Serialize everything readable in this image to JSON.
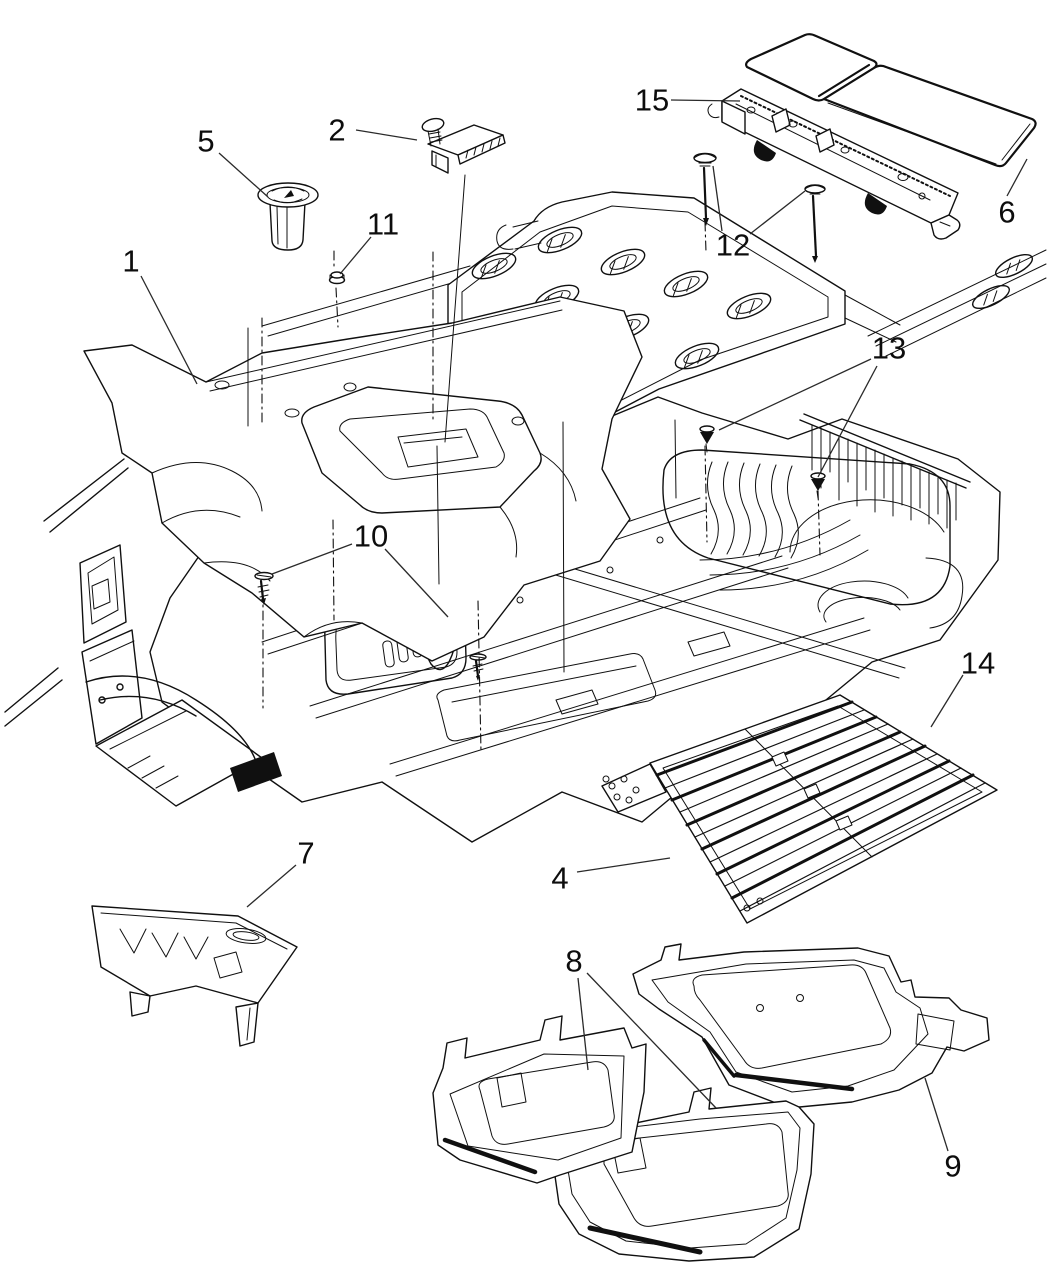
{
  "diagram": {
    "description": "Black-and-white exploded parts line diagram of vehicle floor carpet, mats, bins and fasteners with numbered callouts",
    "background_color": "#ffffff",
    "ink_color": "#101010",
    "label_color": "#0d0d0d",
    "label_font_size": 31,
    "callout_numbers": [
      "1",
      "2",
      "4",
      "5",
      "6",
      "7",
      "8",
      "9",
      "10",
      "11",
      "12",
      "13",
      "14",
      "15"
    ]
  },
  "callouts": [
    {
      "number": "1",
      "x": 131,
      "y": 261,
      "leaders": [
        [
          141,
          276,
          197,
          384
        ]
      ]
    },
    {
      "number": "2",
      "x": 337,
      "y": 130,
      "leaders": [
        [
          356,
          130,
          417,
          140
        ]
      ]
    },
    {
      "number": "4",
      "x": 560,
      "y": 878,
      "leaders": [
        [
          577,
          872,
          670,
          858
        ]
      ]
    },
    {
      "number": "5",
      "x": 206,
      "y": 141,
      "leaders": [
        [
          219,
          153,
          268,
          197
        ]
      ]
    },
    {
      "number": "6",
      "x": 1007,
      "y": 212,
      "leaders": [
        [
          1007,
          196,
          1027,
          159
        ]
      ]
    },
    {
      "number": "7",
      "x": 306,
      "y": 853,
      "leaders": [
        [
          296,
          865,
          247,
          907
        ]
      ]
    },
    {
      "number": "8",
      "x": 574,
      "y": 961,
      "leaders": [
        [
          578,
          978,
          588,
          1070
        ],
        [
          587,
          973,
          716,
          1108
        ]
      ]
    },
    {
      "number": "9",
      "x": 953,
      "y": 1166,
      "leaders": [
        [
          948,
          1151,
          925,
          1078
        ]
      ]
    },
    {
      "number": "10",
      "x": 371,
      "y": 536,
      "leaders": [
        [
          352,
          544,
          272,
          574
        ],
        [
          385,
          549,
          448,
          617
        ]
      ]
    },
    {
      "number": "11",
      "x": 383,
      "y": 224,
      "leaders": [
        [
          371,
          237,
          340,
          274
        ]
      ]
    },
    {
      "number": "12",
      "x": 733,
      "y": 245,
      "leaders": [
        [
          722,
          231,
          713,
          166
        ],
        [
          750,
          234,
          805,
          191
        ]
      ]
    },
    {
      "number": "13",
      "x": 889,
      "y": 348,
      "leaders": [
        [
          871,
          359,
          719,
          430
        ],
        [
          877,
          366,
          818,
          477
        ]
      ]
    },
    {
      "number": "14",
      "x": 978,
      "y": 663,
      "leaders": [
        [
          963,
          675,
          931,
          727
        ]
      ]
    },
    {
      "number": "15",
      "x": 652,
      "y": 100,
      "leaders": [
        [
          671,
          100,
          740,
          101
        ]
      ]
    }
  ]
}
